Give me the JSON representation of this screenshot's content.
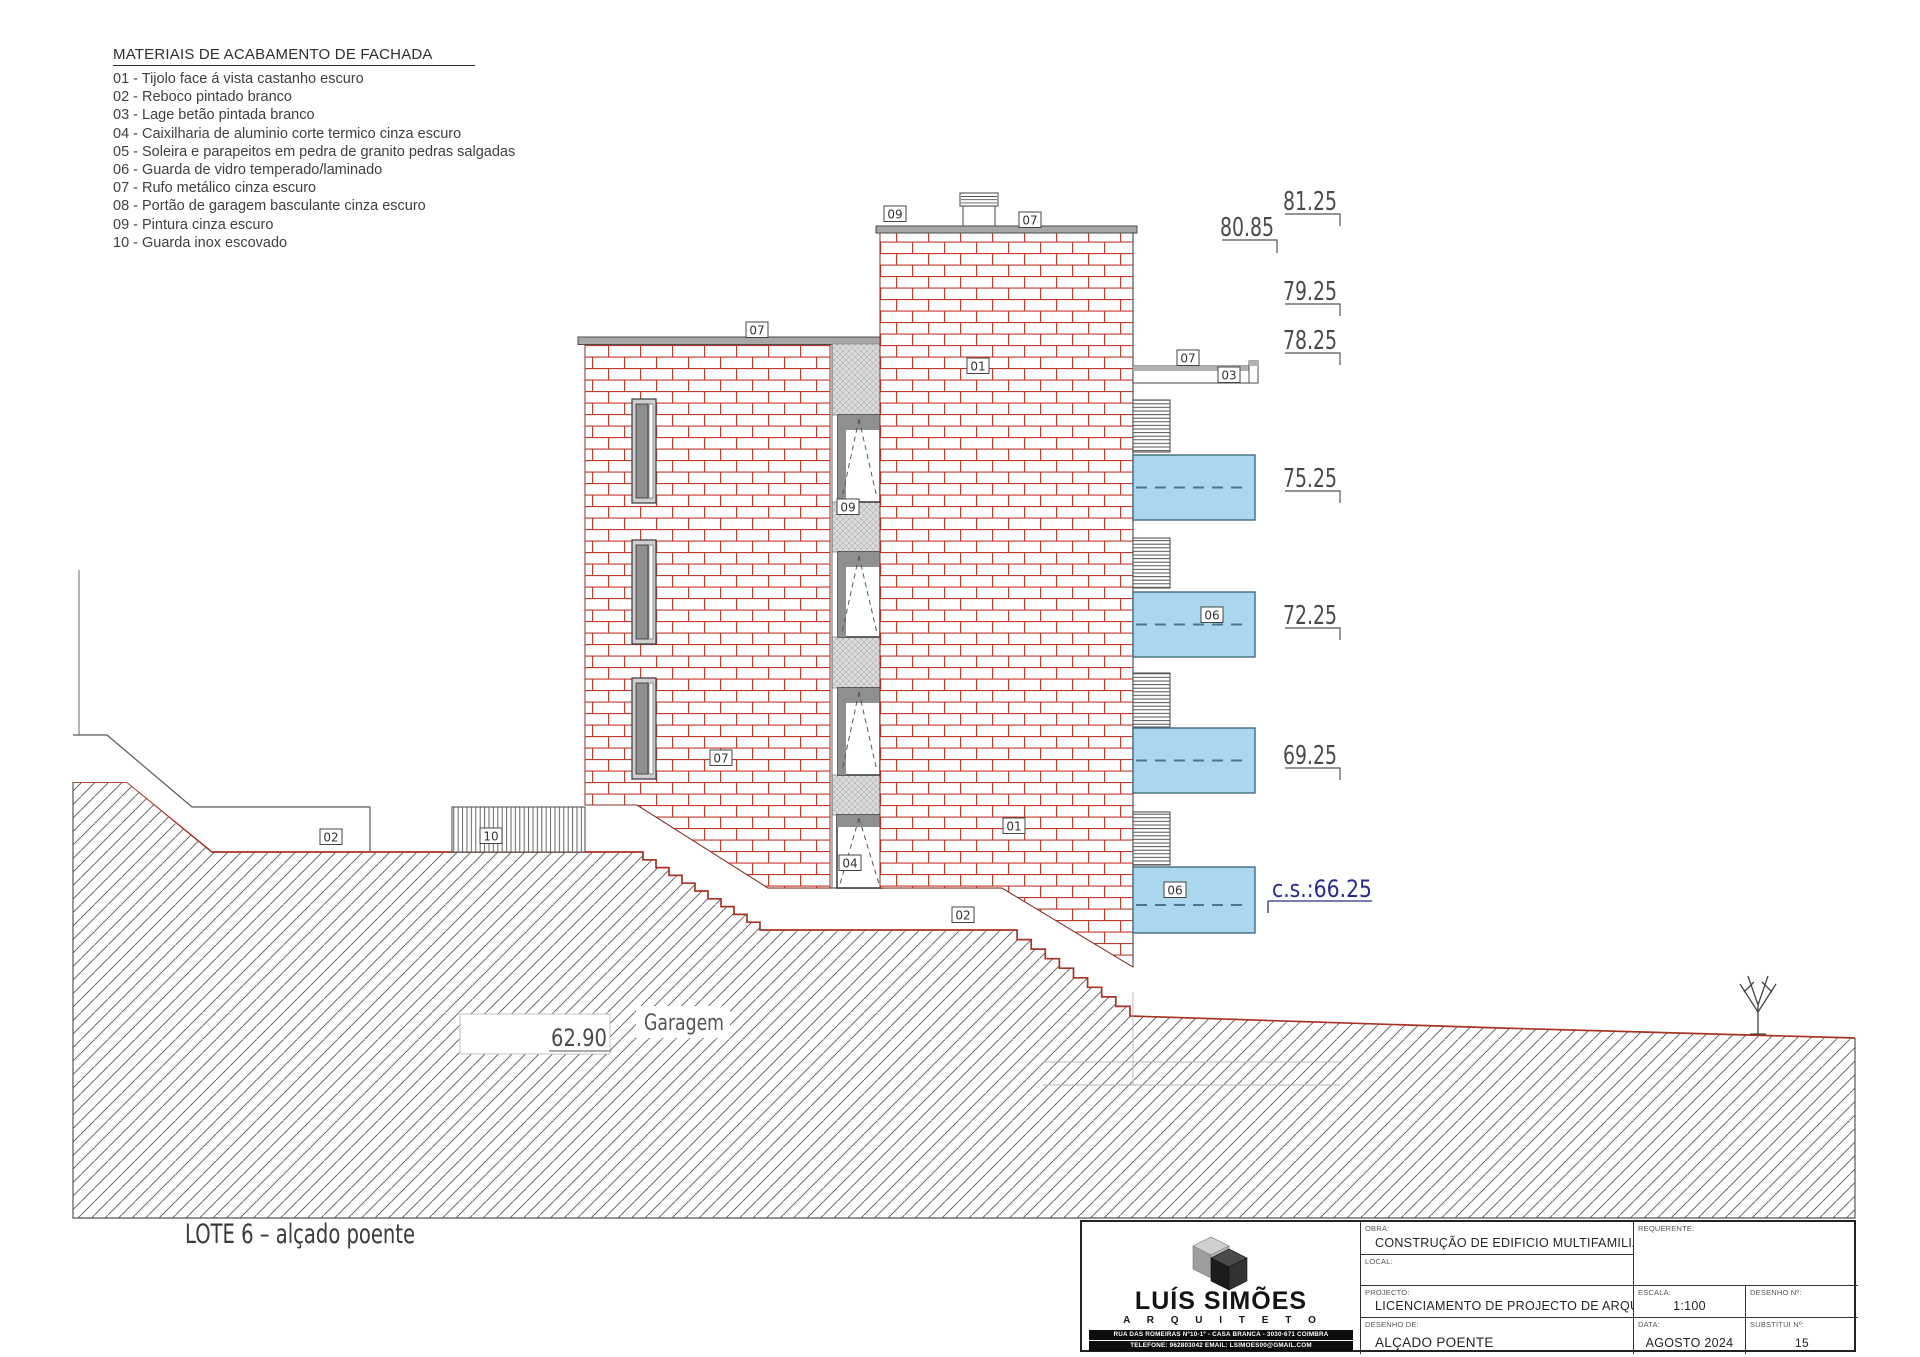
{
  "legend": {
    "title": "MATERIAIS DE ACABAMENTO DE FACHADA",
    "items": [
      "01 - Tijolo face á vista castanho escuro",
      "02 - Reboco pintado branco",
      "03 - Lage betão pintada branco",
      "04 - Caixilharia de aluminio corte termico cinza escuro",
      "05 - Soleira e parapeitos em pedra de granito pedras salgadas",
      "06 - Guarda de vidro temperado/laminado",
      "07 - Rufo metálico cinza escuro",
      "08 - Portão de garagem basculante cinza escuro",
      "09 - Pintura cinza escuro",
      "10 - Guarda inox escovado"
    ]
  },
  "drawing": {
    "tags": [
      "09",
      "07",
      "07",
      "01",
      "07",
      "03",
      "06",
      "06",
      "07",
      "09",
      "04",
      "01",
      "02",
      "10",
      "02"
    ],
    "levels": {
      "l8125": "81.25",
      "l8085": "80.85",
      "l7925": "79.25",
      "l7825": "78.25",
      "l7525": "75.25",
      "l7225": "72.25",
      "l6925": "69.25",
      "cs": "c.s.:66.25",
      "l6290": "62.90"
    },
    "labels": {
      "garage": "Garagem",
      "caption": "LOTE 6 – alçado poente"
    },
    "colors": {
      "brick": "#c03a2b",
      "terrain_surface": "#a93226",
      "balcony_glass": "#aad6ee",
      "cs_level": "#2b2b8c"
    }
  },
  "titleblock": {
    "logo": {
      "name": "LUÍS SIMÕES",
      "subtitle": "A R Q U I T E T O",
      "address": "RUA DAS ROMEIRAS Nº10-1º - CASA BRANCA - 3030-671 COIMBRA",
      "contact": "TELEFONE: 962803042  EMAIL: LSIMOES00@GMAIL.COM"
    },
    "fields": {
      "obra_label": "OBRA:",
      "obra": "CONSTRUÇÃO DE EDIFICIO MULTIFAMILIAR",
      "local_label": "LOCAL:",
      "local": "",
      "projecto_label": "PROJECTO:",
      "projecto": "LICENCIAMENTO DE PROJECTO DE ARQUITETURA",
      "desenho_de_label": "DESENHO DE:",
      "desenho_de": "ALÇADO POENTE",
      "requerente_label": "REQUERENTE:",
      "requerente": "",
      "escala_label": "ESCALA:",
      "escala": "1:100",
      "desenho_n_label": "DESENHO Nº:",
      "desenho_n": "",
      "data_label": "DATA:",
      "data": "AGOSTO 2024",
      "substitui_label": "SUBSTITUI Nº:",
      "substitui": "15"
    }
  }
}
